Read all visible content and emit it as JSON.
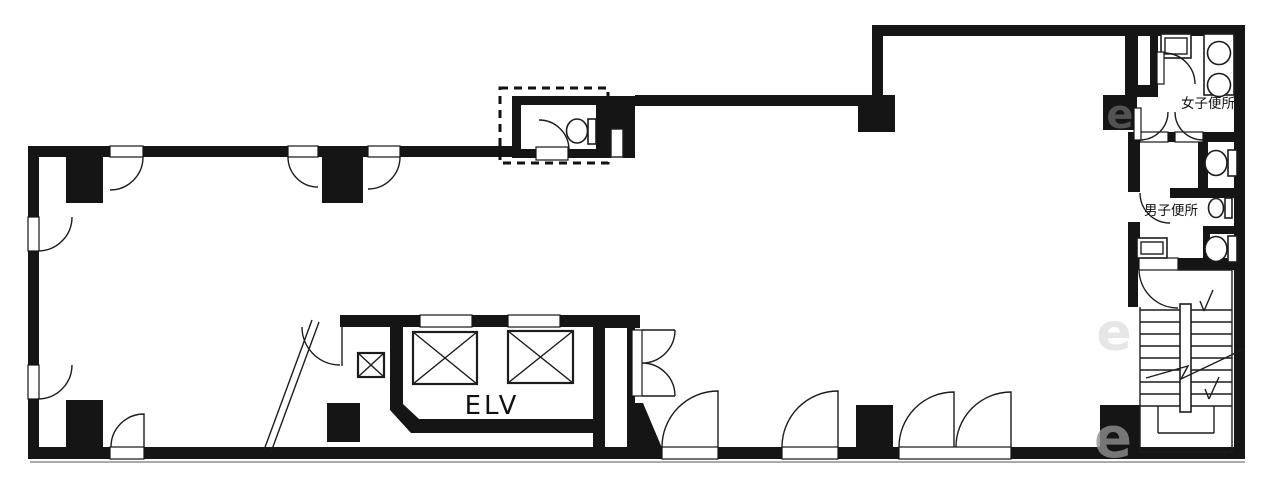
{
  "document": {
    "type": "architectural-floor-plan"
  },
  "labels": {
    "elevator": "ELV",
    "womens_toilet": "女子便所",
    "mens_toilet": "男子便所"
  },
  "watermark": {
    "letters": [
      "e",
      "e",
      "e"
    ]
  },
  "colors": {
    "walls": "#151515",
    "lines": "#1c1c1c",
    "background": "#ffffff",
    "watermark": "#8f8f8f"
  }
}
